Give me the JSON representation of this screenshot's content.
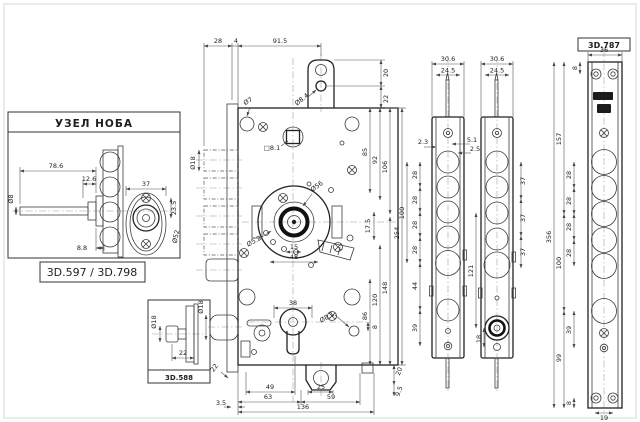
{
  "drawing": {
    "knob_box": {
      "title": "УЗЕЛ НОБА",
      "code_label": "3D.597 / 3D.798",
      "dims": {
        "shaft_length": "78.6",
        "offset": "12.6",
        "tail": "8.8",
        "shaft_dia": "Ø8",
        "plate_width": "37",
        "hole_offset": "23.5",
        "rosette_dia": "Ø52"
      }
    },
    "thumbturn_box": {
      "code_label": "3D.588",
      "dims": {
        "depth": "22",
        "dia": "Ø18"
      }
    },
    "lock_body": {
      "top_dims": {
        "d28": "28",
        "d4": "4",
        "d91_5": "91.5"
      },
      "tab_dims": {
        "hole_dia": "Ø8.4",
        "d20": "20",
        "d22": "22"
      },
      "hole_labels": {
        "top_hole": "Ø7",
        "spindle": "□8.1",
        "bolt_dia": "Ø18",
        "latch_dia": "Ø18",
        "cam_dia": "Ø56",
        "pin_hole": "Ø5.2",
        "screw_hole": "Ø8.1"
      },
      "right_dims": {
        "d85": "85",
        "d92": "92",
        "d106": "106",
        "d254": "254",
        "d86": "86",
        "d120": "120",
        "d148": "148"
      },
      "center_dims": {
        "d15": "15",
        "d48": "48",
        "d17_5": "17.5",
        "d38": "38",
        "d8": "8"
      },
      "bottom_dims": {
        "d49": "49",
        "d63": "63",
        "d25": "25",
        "d59": "59",
        "d136": "136",
        "d3_5": "3.5",
        "d22": "22",
        "d20": "20",
        "d9_5": "9.5"
      }
    },
    "deviator_a": {
      "dims": {
        "w_outer": "30.6",
        "w_inner": "24.5",
        "d2_3": "2.3",
        "d5_1": "5.1",
        "d2_5": "2.5",
        "pitch": "28",
        "d100": "100",
        "d44": "44",
        "d39": "39"
      }
    },
    "deviator_b": {
      "dims": {
        "w_outer": "30.6",
        "w_inner": "24.5",
        "pitch": "37",
        "d121": "121",
        "d18": "18"
      }
    },
    "strike_plate": {
      "code_label": "3D.787",
      "dims": {
        "w36": "36",
        "d8_top": "8",
        "d157": "157",
        "pitch": "28",
        "d100": "100",
        "d356": "356",
        "d39": "39",
        "d99": "99",
        "d8_bottom": "8",
        "w19": "19"
      }
    }
  }
}
